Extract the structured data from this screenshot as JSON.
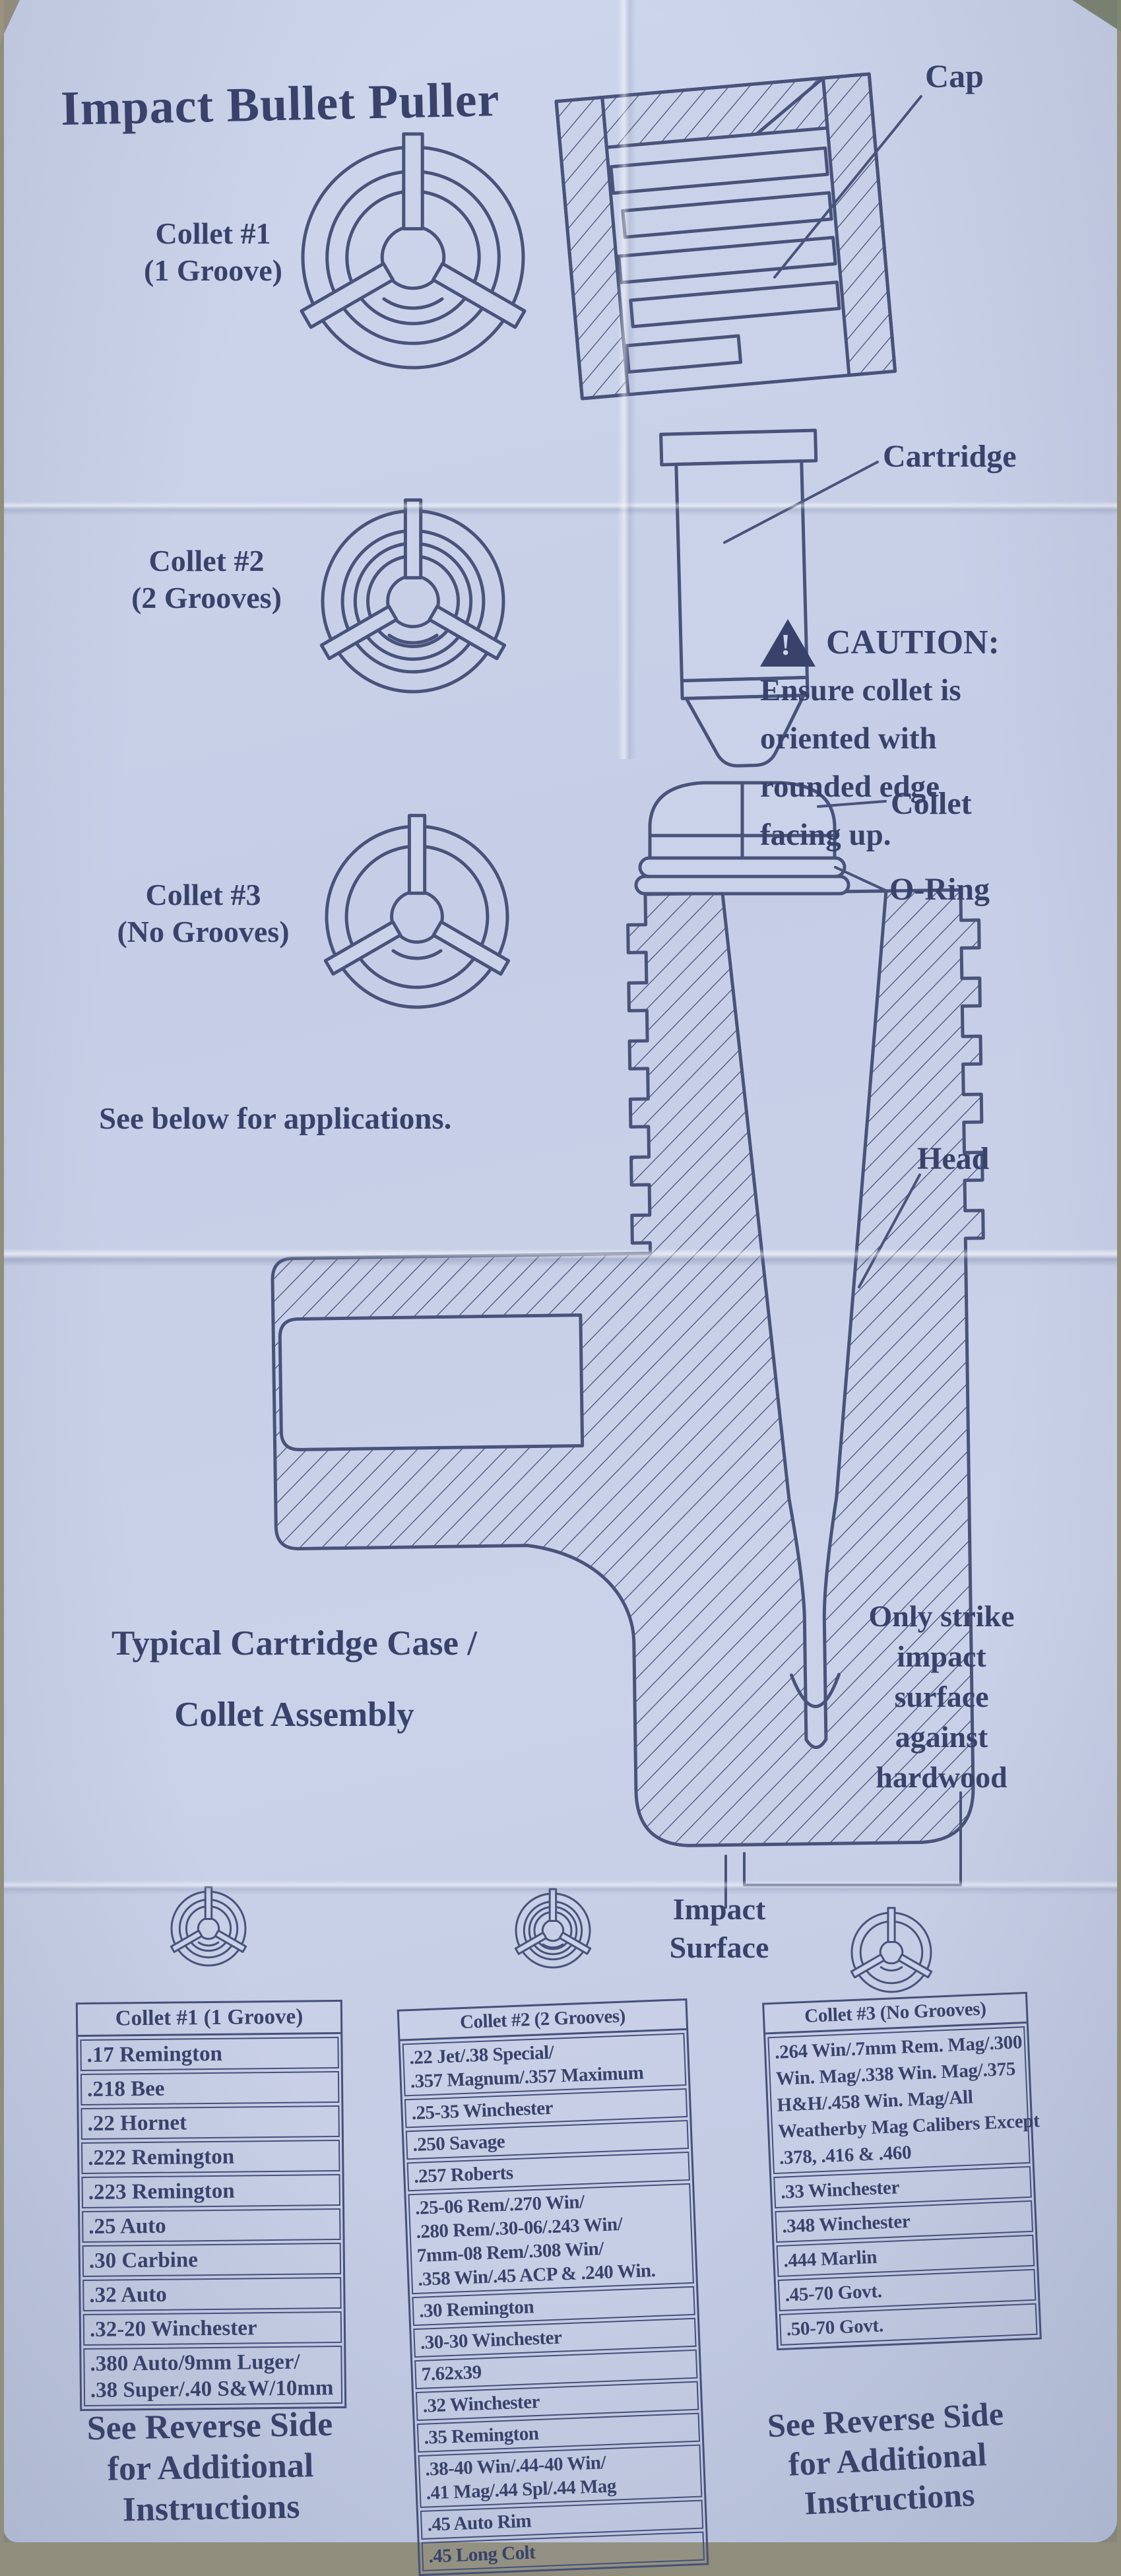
{
  "document": {
    "title": "Impact Bullet Puller",
    "see_below_note": "See below for applications.",
    "assembly_caption": [
      "Typical Cartridge Case /",
      "Collet Assembly"
    ],
    "strike_note": [
      "Only strike",
      "impact",
      "surface",
      "against",
      "hardwood"
    ],
    "impact_surface_label": [
      "Impact",
      "Surface"
    ],
    "reverse_note": [
      "See Reverse Side",
      "for Additional",
      "Instructions"
    ]
  },
  "caution": {
    "title": "CAUTION:",
    "lines": [
      "Ensure collet is",
      "oriented with",
      "rounded edge",
      "facing up."
    ]
  },
  "collet_legend": [
    {
      "name": "Collet #1",
      "sub": "(1 Groove)",
      "grooves": 1
    },
    {
      "name": "Collet #2",
      "sub": "(2 Grooves)",
      "grooves": 2
    },
    {
      "name": "Collet #3",
      "sub": "(No Grooves)",
      "grooves": 0
    }
  ],
  "diagram_labels": {
    "cap": "Cap",
    "cartridge": "Cartridge",
    "collet": "Collet",
    "o_ring": "O-Ring",
    "head": "Head"
  },
  "tables": [
    {
      "header": "Collet #1 (1 Groove)",
      "rows": [
        [
          ".17 Remington"
        ],
        [
          ".218 Bee"
        ],
        [
          ".22 Hornet"
        ],
        [
          ".222 Remington"
        ],
        [
          ".223 Remington"
        ],
        [
          ".25 Auto"
        ],
        [
          ".30 Carbine"
        ],
        [
          ".32 Auto"
        ],
        [
          ".32-20 Winchester"
        ],
        [
          ".380 Auto/9mm Luger/",
          ".38 Super/.40 S&W/10mm"
        ]
      ]
    },
    {
      "header": "Collet #2 (2 Grooves)",
      "rows": [
        [
          ".22 Jet/.38 Special/",
          ".357 Magnum/.357 Maximum"
        ],
        [
          ".25-35 Winchester"
        ],
        [
          ".250 Savage"
        ],
        [
          ".257 Roberts"
        ],
        [
          ".25-06 Rem/.270 Win/",
          ".280 Rem/.30-06/.243 Win/",
          "7mm-08 Rem/.308 Win/",
          ".358 Win/.45 ACP & .240 Win."
        ],
        [
          ".30 Remington"
        ],
        [
          ".30-30 Winchester"
        ],
        [
          "7.62x39"
        ],
        [
          ".32 Winchester"
        ],
        [
          ".35 Remington"
        ],
        [
          ".38-40 Win/.44-40 Win/",
          ".41 Mag/.44 Spl/.44 Mag"
        ],
        [
          ".45 Auto Rim"
        ],
        [
          ".45 Long Colt"
        ]
      ]
    },
    {
      "header": "Collet #3 (No Grooves)",
      "rows": [
        [
          ".264 Win/.7mm Rem. Mag/.300",
          "Win. Mag/.338 Win. Mag/.375",
          "H&H/.458 Win. Mag/All",
          "Weatherby Mag Calibers Except",
          ".378, .416 & .460"
        ],
        [
          ".33 Winchester"
        ],
        [
          ".348 Winchester"
        ],
        [
          ".444 Marlin"
        ],
        [
          ".45-70 Govt."
        ],
        [
          ".50-70 Govt."
        ]
      ]
    }
  ],
  "colors": {
    "ink": "#3f4869",
    "line": "#49537a",
    "paper": "#cad2e9"
  }
}
